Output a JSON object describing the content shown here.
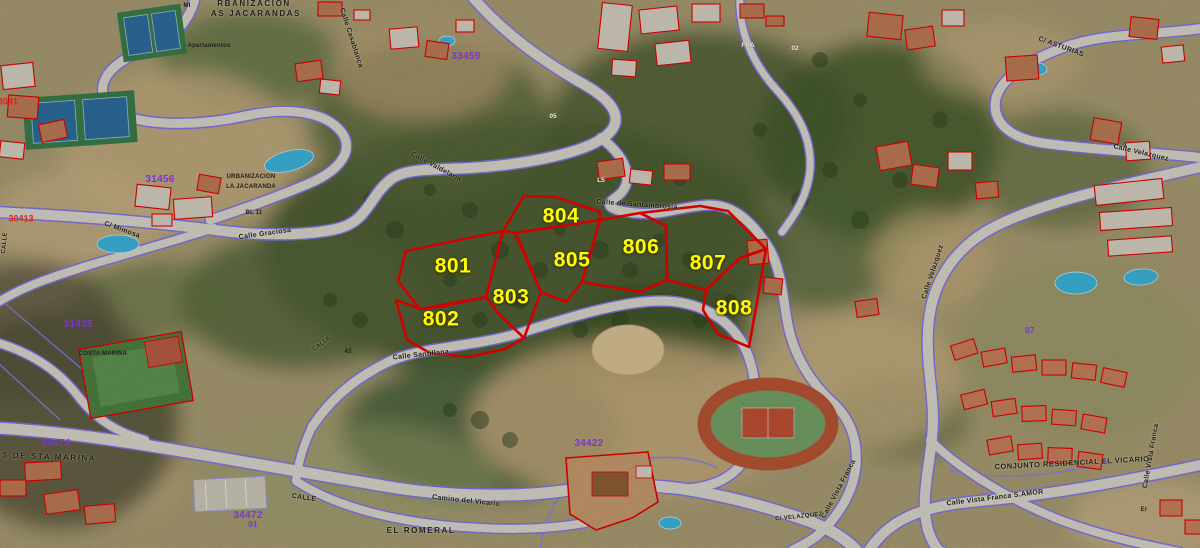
{
  "map": {
    "type": "aerial-cadastral-map",
    "colors": {
      "parcel_outline": "#ee0000",
      "parcel_number_yellow": "#ffff00",
      "road_casing_purple": "#8273ea",
      "cadastral_ref_purple": "#7d35cf",
      "cadastral_ref_red": "#e32222",
      "building_outline_red": "#e60000",
      "pool_blue": "#3db4da"
    },
    "parcel_numbers": [
      {
        "text": "801",
        "x": 453,
        "y": 266,
        "r": 0
      },
      {
        "text": "802",
        "x": 441,
        "y": 319,
        "r": 0
      },
      {
        "text": "803",
        "x": 511,
        "y": 297,
        "r": 0
      },
      {
        "text": "804",
        "x": 561,
        "y": 216,
        "r": 0
      },
      {
        "text": "805",
        "x": 572,
        "y": 260,
        "r": 0
      },
      {
        "text": "806",
        "x": 641,
        "y": 247,
        "r": 0
      },
      {
        "text": "807",
        "x": 708,
        "y": 263,
        "r": 0
      },
      {
        "text": "808",
        "x": 734,
        "y": 308,
        "r": 0
      }
    ],
    "street_names": [
      {
        "text": "Calle de Santambrosia",
        "x": 637,
        "y": 205,
        "r": 4
      },
      {
        "text": "Calle Valdelaria",
        "x": 436,
        "y": 167,
        "r": 28
      },
      {
        "text": "Calle Graciosa",
        "x": 265,
        "y": 234,
        "r": -8
      },
      {
        "text": "Calle Casablanca",
        "x": 351,
        "y": 38,
        "r": 72
      },
      {
        "text": "Calle Santillana",
        "x": 421,
        "y": 355,
        "r": -6
      },
      {
        "text": "CALLE",
        "x": 304,
        "y": 498,
        "r": 8
      },
      {
        "text": "CALLE",
        "x": 322,
        "y": 344,
        "r": -38,
        "fs": 6
      },
      {
        "text": "CALLE",
        "x": 5,
        "y": 243,
        "r": -85,
        "fs": 6
      },
      {
        "text": "Camino del Vicario",
        "x": 466,
        "y": 501,
        "r": 6
      },
      {
        "text": "C/ VELAZQUEZ",
        "x": 799,
        "y": 517,
        "r": -6,
        "fs": 6
      },
      {
        "text": "Calle Vista Franca",
        "x": 839,
        "y": 489,
        "r": -62
      },
      {
        "text": "Calle Vista Franca S.AMOR",
        "x": 995,
        "y": 498,
        "r": -7
      },
      {
        "text": "Calle Velazquez",
        "x": 1141,
        "y": 153,
        "r": 13
      },
      {
        "text": "Calle Velazquez",
        "x": 933,
        "y": 272,
        "r": -72
      },
      {
        "text": "C/ ASTURIAS",
        "x": 1061,
        "y": 47,
        "r": 20
      },
      {
        "text": "Calle Vista Franca",
        "x": 1151,
        "y": 456,
        "r": -80
      },
      {
        "text": "C/ Mimosa",
        "x": 122,
        "y": 230,
        "r": 20
      }
    ],
    "area_names": [
      {
        "text": "RBANIZACION",
        "x": 254,
        "y": 4,
        "r": 0
      },
      {
        "text": "AS JACARANDAS",
        "x": 256,
        "y": 14,
        "r": 0
      },
      {
        "text": "EL ROMERAL",
        "x": 421,
        "y": 531,
        "r": 0
      },
      {
        "text": "CONJUNTO RESIDENCIAL EL VICARIO",
        "x": 1072,
        "y": 463,
        "r": -3,
        "fs": 7.5,
        "ls": 0.5
      },
      {
        "text": "NES DE STA MARINA",
        "x": 42,
        "y": 457,
        "r": 2
      }
    ],
    "cadastral_refs_purple": [
      {
        "text": "33459",
        "x": 466,
        "y": 57,
        "r": 0
      },
      {
        "text": "31456",
        "x": 160,
        "y": 180,
        "r": 0
      },
      {
        "text": "31435",
        "x": 78,
        "y": 325,
        "r": 0
      },
      {
        "text": "34422",
        "x": 589,
        "y": 444,
        "r": 0
      },
      {
        "text": "30474",
        "x": 56,
        "y": 444,
        "r": 0
      },
      {
        "text": "34472",
        "x": 248,
        "y": 516,
        "r": 0
      },
      {
        "text": "01",
        "x": 253,
        "y": 525,
        "r": 0,
        "fs": 8
      },
      {
        "text": "07",
        "x": 1030,
        "y": 331,
        "r": 0,
        "fs": 8
      }
    ],
    "cadastral_refs_red": [
      {
        "text": "30413",
        "x": 21,
        "y": 219,
        "r": 0
      },
      {
        "text": "3041",
        "x": 8,
        "y": 102,
        "r": 0
      }
    ],
    "small_labels": [
      {
        "text": "URBANIZACION",
        "x": 251,
        "y": 177,
        "r": 0
      },
      {
        "text": "LA JACARANDA",
        "x": 251,
        "y": 187,
        "r": 0
      },
      {
        "text": "MI",
        "x": 187,
        "y": 6,
        "r": 0
      },
      {
        "text": "Apartamentos",
        "x": 209,
        "y": 46,
        "r": 0
      },
      {
        "text": "BL 11",
        "x": 254,
        "y": 213,
        "r": 0
      },
      {
        "text": "43",
        "x": 348,
        "y": 352,
        "r": 0
      },
      {
        "text": "COSTA MARINA",
        "x": 103,
        "y": 354,
        "r": 0
      },
      {
        "text": "Er",
        "x": 1144,
        "y": 510,
        "r": 0
      }
    ],
    "white_labels": [
      {
        "text": "FRA",
        "x": 748,
        "y": 46,
        "r": 0
      },
      {
        "text": "05",
        "x": 553,
        "y": 117,
        "r": 0
      },
      {
        "text": "L5",
        "x": 601,
        "y": 181,
        "r": 0
      },
      {
        "text": "02",
        "x": 795,
        "y": 49,
        "r": 0
      }
    ]
  }
}
